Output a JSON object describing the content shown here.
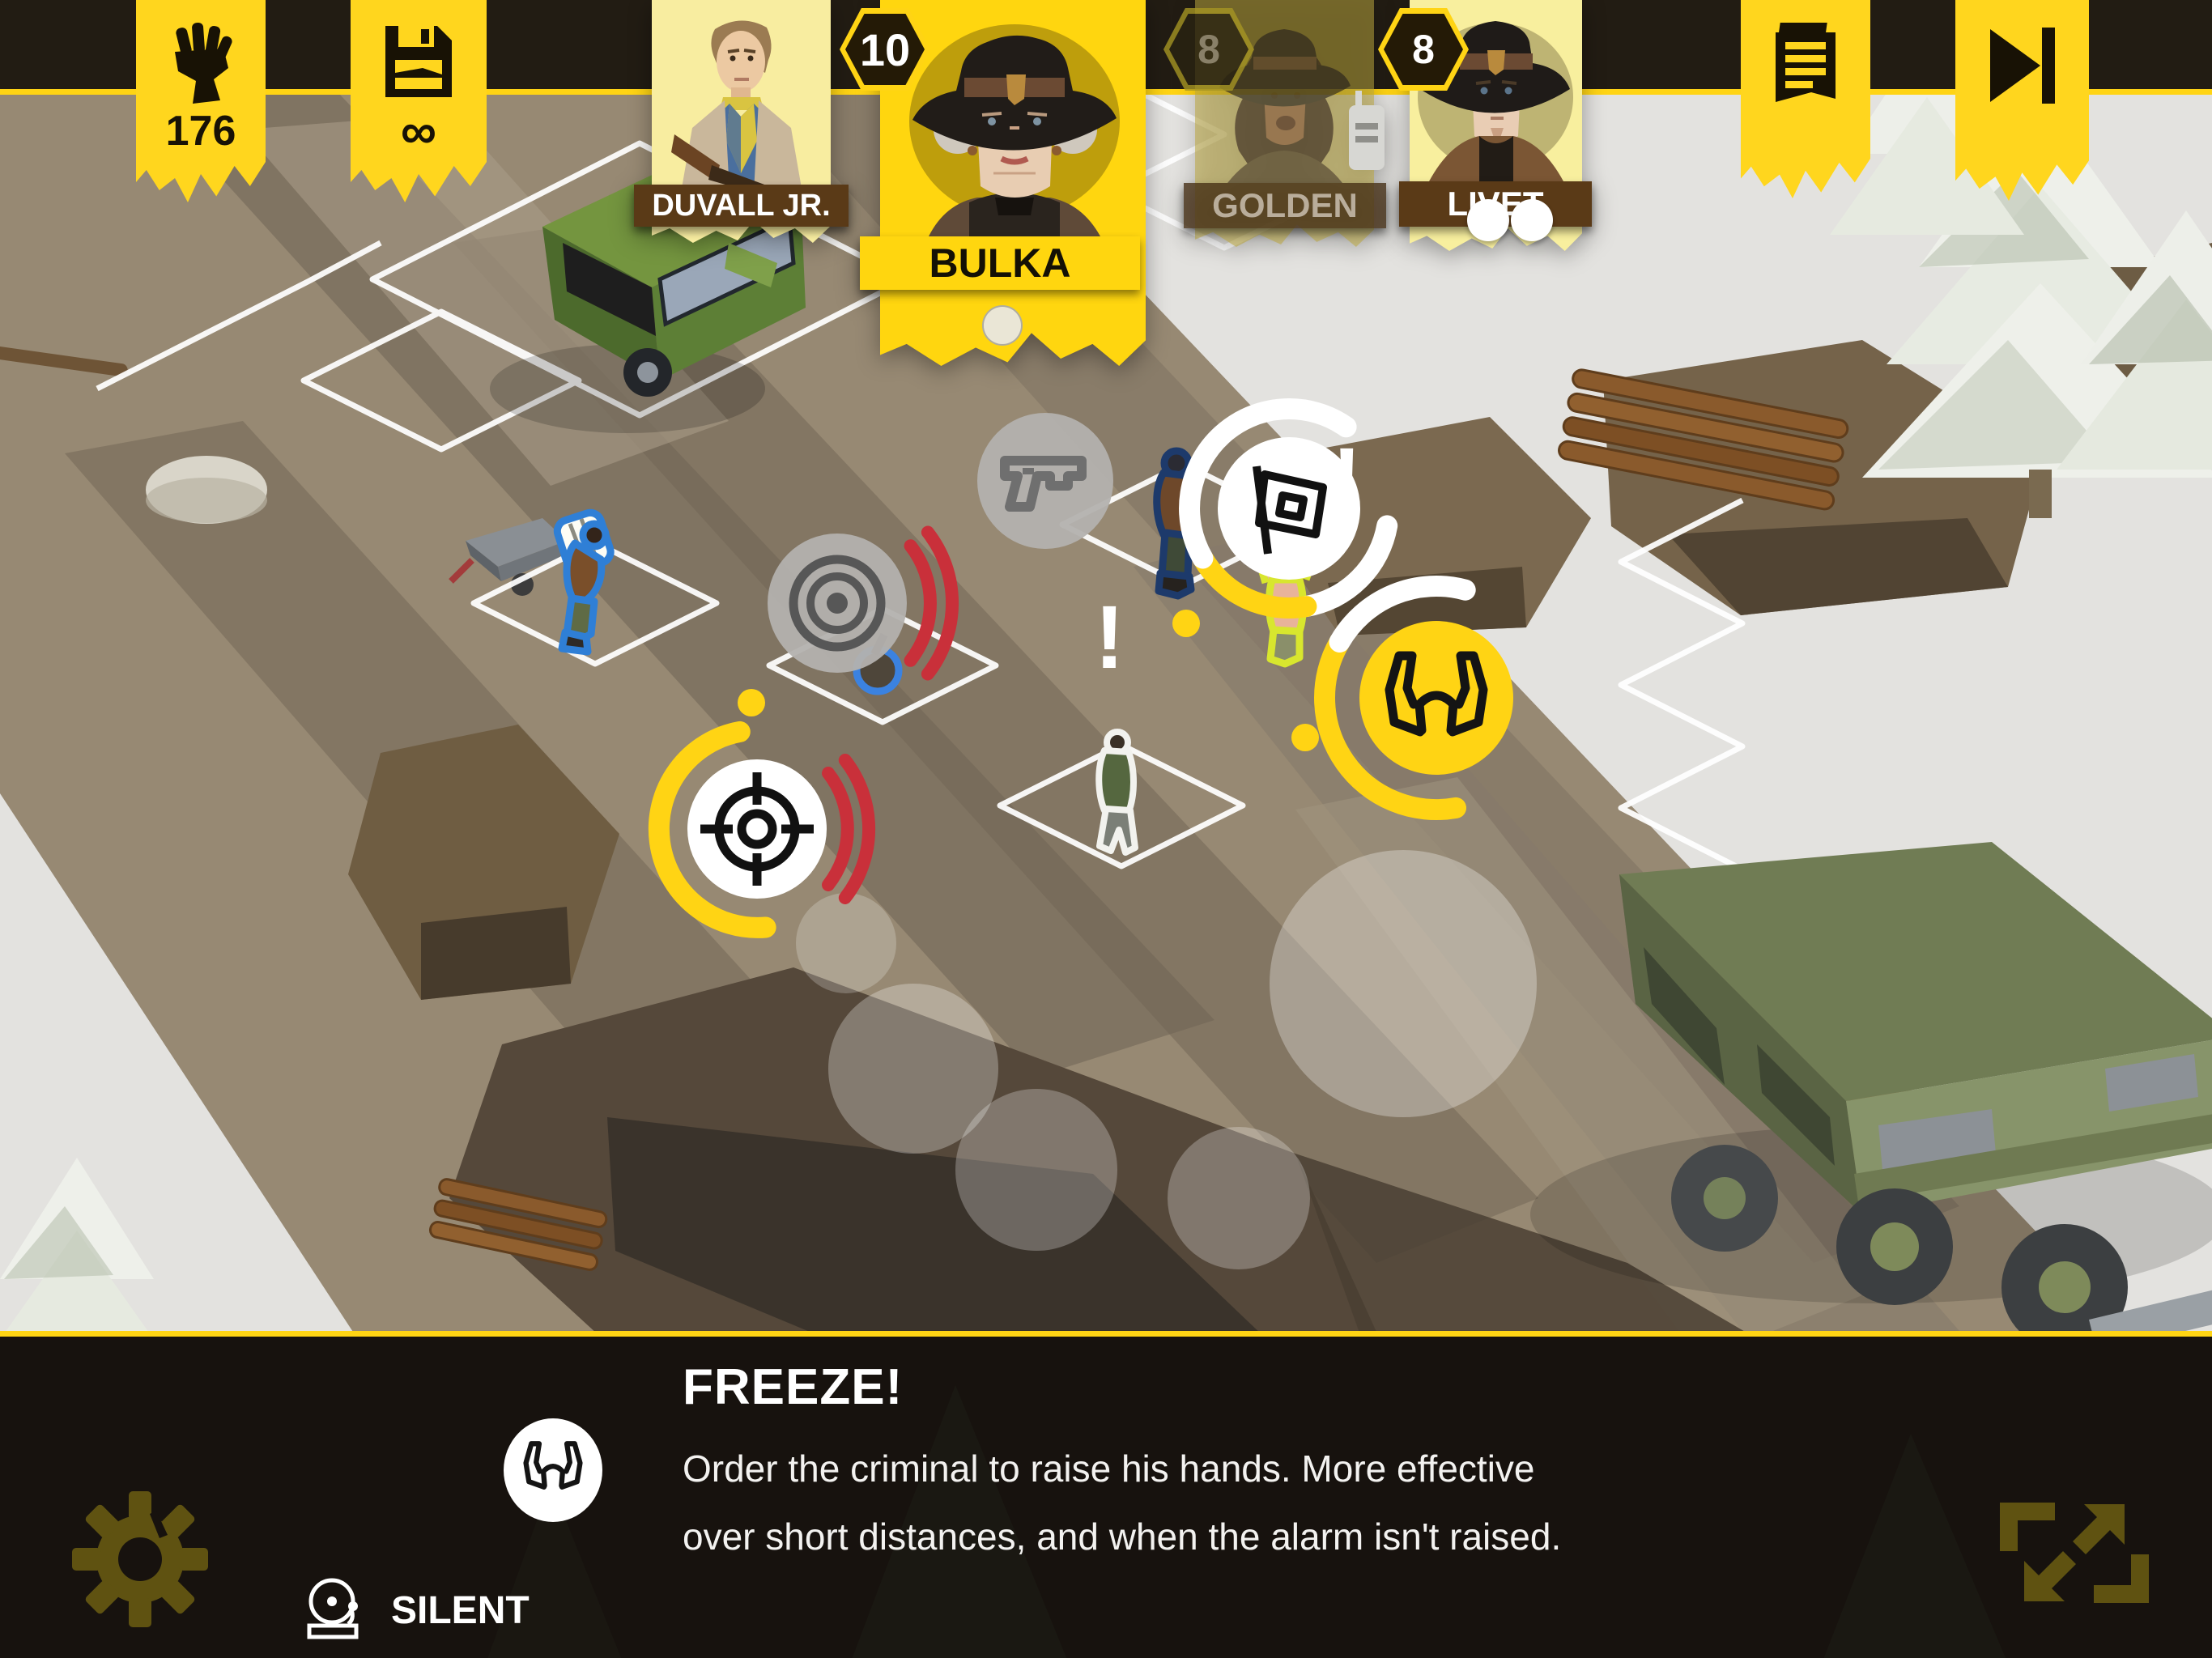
{
  "hud": {
    "morale_counter": {
      "value": "176",
      "icon": "fist-icon"
    },
    "saves_counter": {
      "value": "∞",
      "icon": "floppy-disk-icon"
    },
    "journal_button": {
      "icon": "journal-icon"
    },
    "end_turn_button": {
      "icon": "end-turn-icon"
    },
    "squad": [
      {
        "name": "DUVALL JR.",
        "badge": "",
        "state": "available",
        "dots": 0
      },
      {
        "name": "BULKA",
        "badge": "10",
        "state": "selected",
        "dots": 1
      },
      {
        "name": "GOLDEN",
        "badge": "8",
        "state": "exhausted",
        "dots": 0
      },
      {
        "name": "LIVET",
        "badge": "8",
        "state": "available",
        "dots": 2
      }
    ]
  },
  "map": {
    "exclamation": "!",
    "action_icons": {
      "shoot": "pistol-icon",
      "alarm": "siren-icon",
      "warn": "flag-icon",
      "aim": "crosshair-icon",
      "freeze": "hands-up-icon"
    }
  },
  "panel": {
    "title": "FREEZE!",
    "description_line1": "Order the criminal to raise his hands. More effective",
    "description_line2": "over short distances, and when the alarm isn't raised.",
    "tag": "SILENT",
    "tag_icon": "alarm-bell-icon",
    "ability_icon": "hands-up-icon"
  },
  "corner_icons": {
    "settings": "gear-icon",
    "fullscreen": "expand-icon"
  },
  "colors": {
    "accent_yellow": "#ffd414",
    "banner_yellow": "#ffd61e",
    "card_selected": "#ffd60f",
    "card_pale": "#f8eda0",
    "nameplate_brown": "#5a3a17",
    "panel_bg": "#17120e",
    "alert_red": "#c9303a",
    "road_tan": "#978973",
    "outline_blue": "#2f7fd6",
    "outline_yellow": "#d8e62e"
  }
}
